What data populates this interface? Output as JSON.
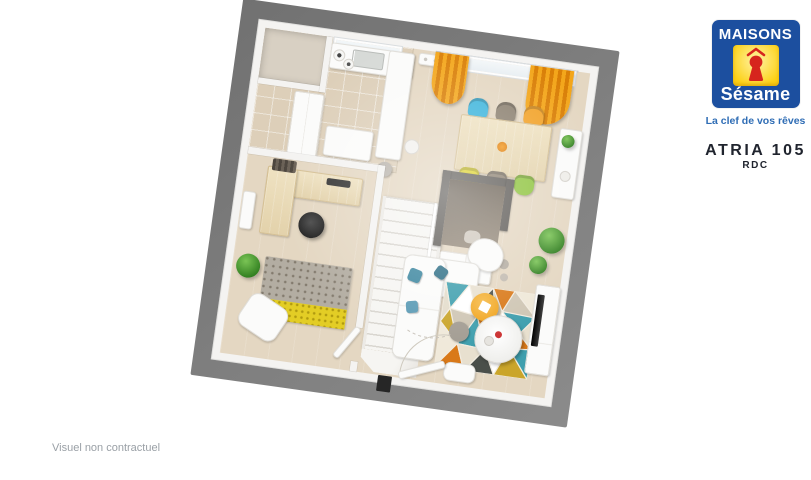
{
  "logo": {
    "brand_top": "MAISONS",
    "brand_bottom": "Sésame",
    "tagline": "La clef de vos rêves"
  },
  "plan": {
    "title": "ATRIA 105",
    "floor": "RDC"
  },
  "footer": {
    "disclaimer": "Visuel non contractuel"
  },
  "colors": {
    "logo_blue": "#1c4f9f",
    "logo_yellow": "#fcd116",
    "logo_yellow_light": "#fff3a6",
    "logo_red": "#d6251d",
    "tagline_blue": "#2f6db5",
    "title_dark": "#20242e",
    "disclaimer_gray": "#9aa0a6",
    "frame_gray": "#7c7c7c",
    "wall_white": "#f4f3f1",
    "floor_beige": "#e4d7c2",
    "tile_beige": "#ddcfb9",
    "wood_light": "#eadbb9",
    "curtain_orange": "#e59312",
    "chair_blue": "#3eb5dc",
    "chair_orange": "#f2a32a",
    "chair_yellow": "#ddd22b",
    "chair_green": "#8fc43f",
    "chair_taupe": "#8d8272",
    "pouf_orange": "#f0a41f",
    "plant_green": "#3f9b2f",
    "dark_wall": "#5d5a56",
    "rug_gray": "#b3ada2",
    "rug_yellow": "#e3cd25"
  }
}
